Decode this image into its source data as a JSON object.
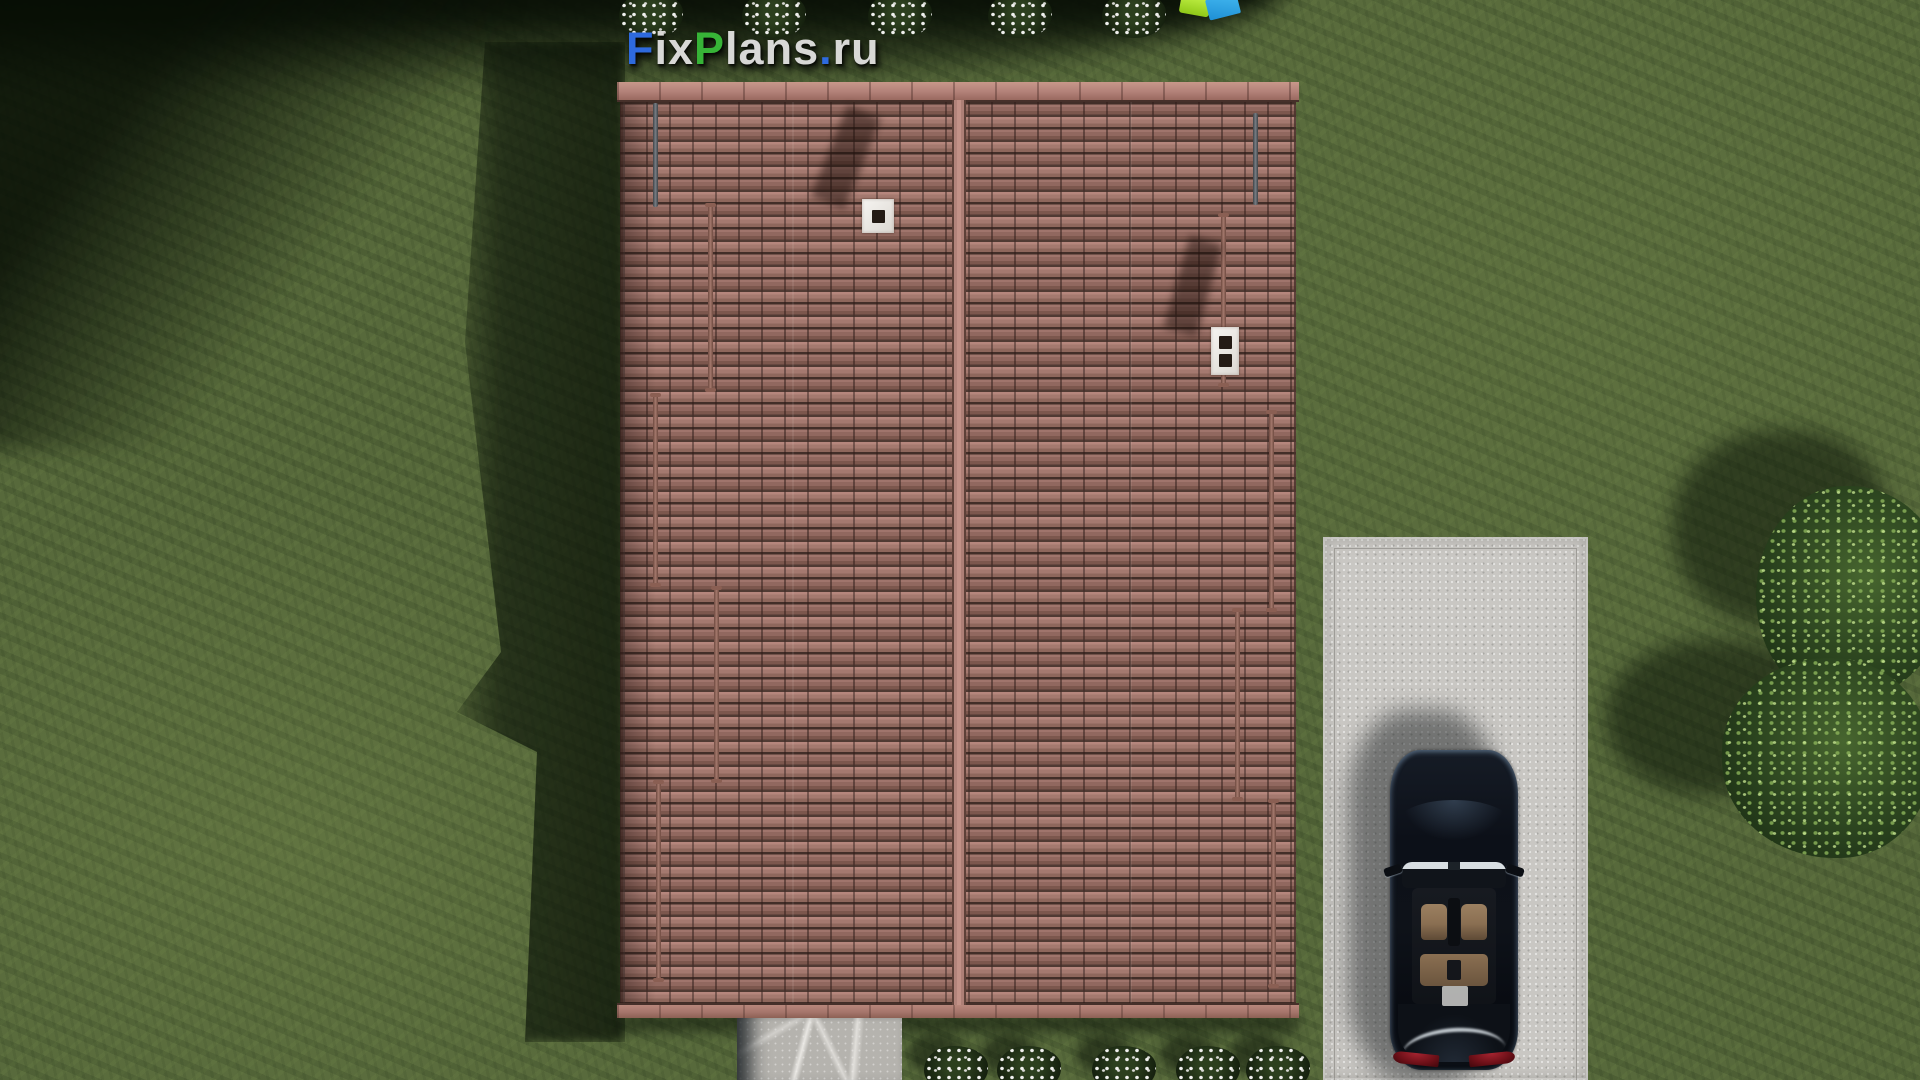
{
  "watermark": {
    "segments": [
      {
        "text": "F",
        "color": "#2e6add"
      },
      {
        "text": "ix",
        "color": "#d8d8d6"
      },
      {
        "text": "P",
        "color": "#37b437"
      },
      {
        "text": "lans",
        "color": "#d8d8d6"
      },
      {
        "text": ".",
        "color": "#2e6add"
      },
      {
        "text": "ru",
        "color": "#d8d8d6"
      }
    ],
    "full_text": "FixPlans.ru"
  },
  "scene": {
    "description": "Aerial top-down 3D render: brown tiled gable roof with two white chimneys and snow-guard rails, green lawn, concrete driveway with dark sedan, stone walkway, two trees, white flower bushes along top and bottom edges, small lime/blue toy at top edge"
  },
  "colors": {
    "grass": "#57693b",
    "grass_shadow": "#0a1406",
    "roof_tile": "#9c7065",
    "roof_ridge": "#b4837a",
    "rod_brown": "#a4786c",
    "rod_gray": "#787e84",
    "chimney_white": "#f6f4f1",
    "flue_dark": "#241b15",
    "driveway": "#c9c7c3",
    "walkway": "#b5b3ae",
    "car_body": "#0c1018",
    "car_interior": "#8a6f52",
    "taillight": "#6d1018",
    "tree_green": "#2a421e",
    "flower_white": "#f1f1ef",
    "toy_lime": "#8fc818",
    "toy_blue": "#1e8fd4",
    "logo_blue": "#2e6add",
    "logo_green": "#37b437",
    "logo_white": "#d8d8d6"
  }
}
